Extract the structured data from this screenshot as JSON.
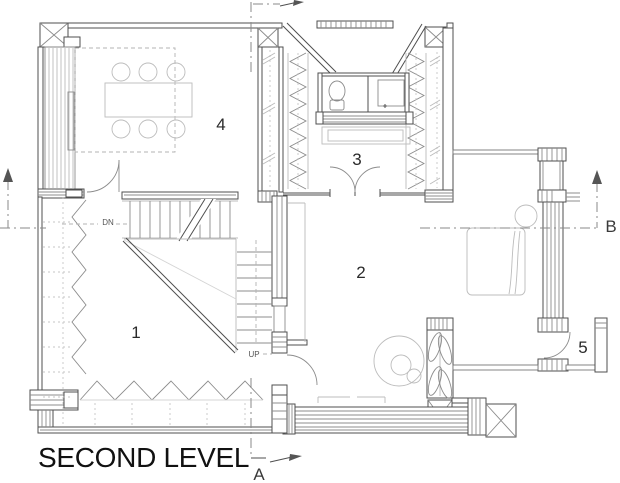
{
  "title": {
    "text": "SECOND LEVEL"
  },
  "rooms": {
    "r1": "1",
    "r2": "2",
    "r3": "3",
    "r4": "4",
    "r5": "5"
  },
  "stairs": {
    "down": "DN",
    "up": "UP"
  },
  "markers": {
    "a": "A",
    "b": "B"
  },
  "palette": {
    "wall": "#4f4f4f",
    "medium": "#8c8c8c",
    "light": "#bcbcbc",
    "dashed": "#b3b3b3",
    "text": "#111111",
    "background": "#ffffff"
  }
}
